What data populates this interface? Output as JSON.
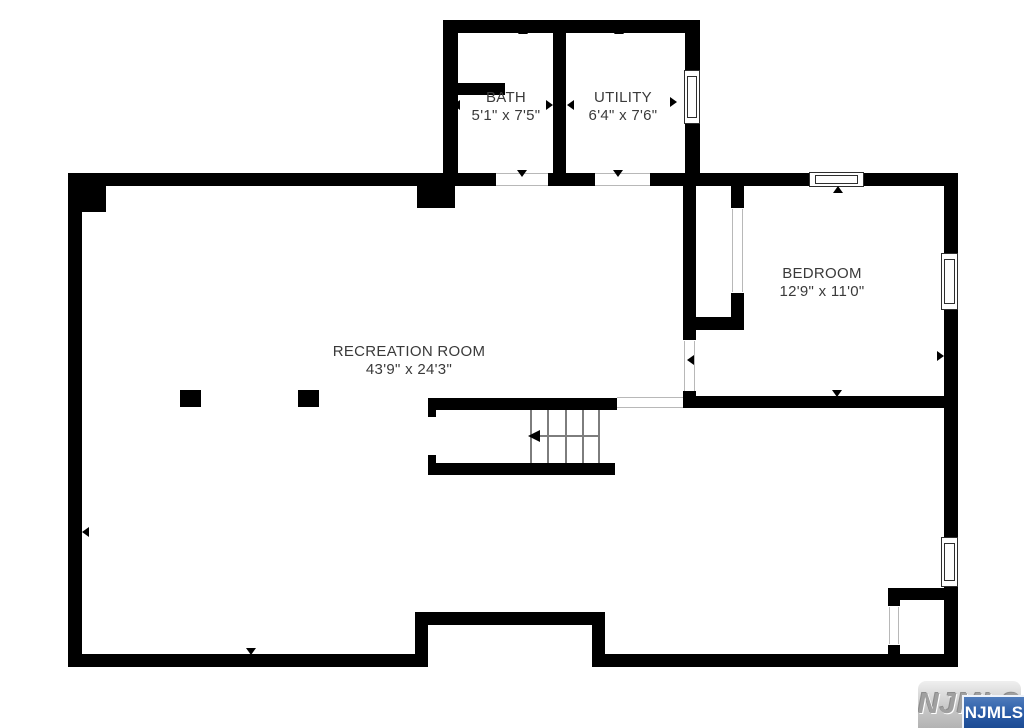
{
  "rooms": {
    "bath": {
      "name": "BATH",
      "dims": "5'1\" x 7'5\""
    },
    "utility": {
      "name": "UTILITY",
      "dims": "6'4\" x 7'6\""
    },
    "bedroom": {
      "name": "BEDROOM",
      "dims": "12'9\" x 11'0\""
    },
    "recreation": {
      "name": "RECREATION ROOM",
      "dims": "43'9\" x 24'3\""
    }
  },
  "watermark": {
    "embossed_text": "NJMLS",
    "badge_text": "NJMLS"
  },
  "colors": {
    "wall": "#000000",
    "label_text": "#3a3a3a",
    "stair_line": "#7d7d7d",
    "badge_blue": "#2a5ba6",
    "watermark_gray": "#c9c9c9"
  }
}
